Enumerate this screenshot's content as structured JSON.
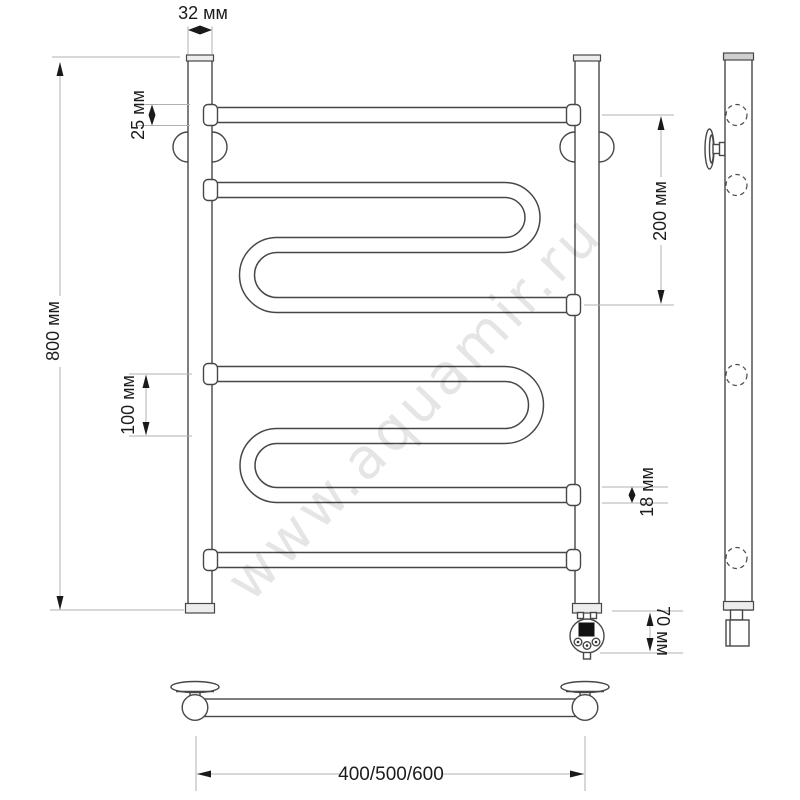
{
  "watermark": {
    "text": "www.aquamir.ru"
  },
  "labels": {
    "post_width": "32 мм",
    "top_rail_offset": "25 мм",
    "overall_height": "800 мм",
    "rail_spacing_small": "100 мм",
    "upper_section_height": "200 мм",
    "tube_diameter": "18 мм",
    "heater_offset": "70 мм",
    "width_variants": "400/500/600"
  },
  "colors": {
    "ink": "#474747",
    "extension_line": "#b2b2b2",
    "dimension_marks": "#1a1a1a",
    "watermark": "rgba(0,0,0,0.10)",
    "background": "#ffffff"
  }
}
